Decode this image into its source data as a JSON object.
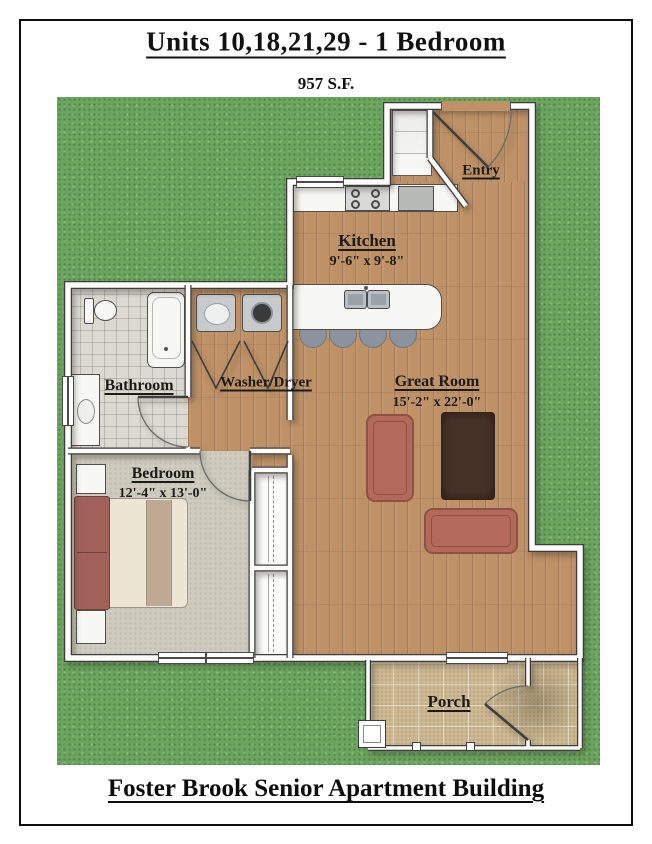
{
  "header": {
    "title": "Units 10,18,21,29 - 1 Bedroom",
    "square_footage": "957 S.F."
  },
  "footer": {
    "building_name": "Foster Brook Senior Apartment Building"
  },
  "rooms": {
    "entry": {
      "label": "Entry"
    },
    "kitchen": {
      "label": "Kitchen",
      "dimensions": "9'-6\" x 9'-8\""
    },
    "bathroom": {
      "label": "Bathroom"
    },
    "washer_dryer": {
      "label": "Washer/Dryer"
    },
    "great_room": {
      "label": "Great Room",
      "dimensions": "15'-2\" x 22'-0\""
    },
    "bedroom": {
      "label": "Bedroom",
      "dimensions": "12'-4\" x 13'-0\""
    },
    "porch": {
      "label": "Porch"
    }
  },
  "colors": {
    "grass": "#6CA55F",
    "wood_floor": "#BE9166",
    "tile_floor": "#DBDAD2",
    "carpet_floor": "#CFCCBF",
    "paver_floor": "#CDB993",
    "wall": "#FBFBFB",
    "wall_outline": "#3E3E3E",
    "sofa": "#B46A5B",
    "rug": "#463227",
    "label_text": "#1D1B18"
  }
}
